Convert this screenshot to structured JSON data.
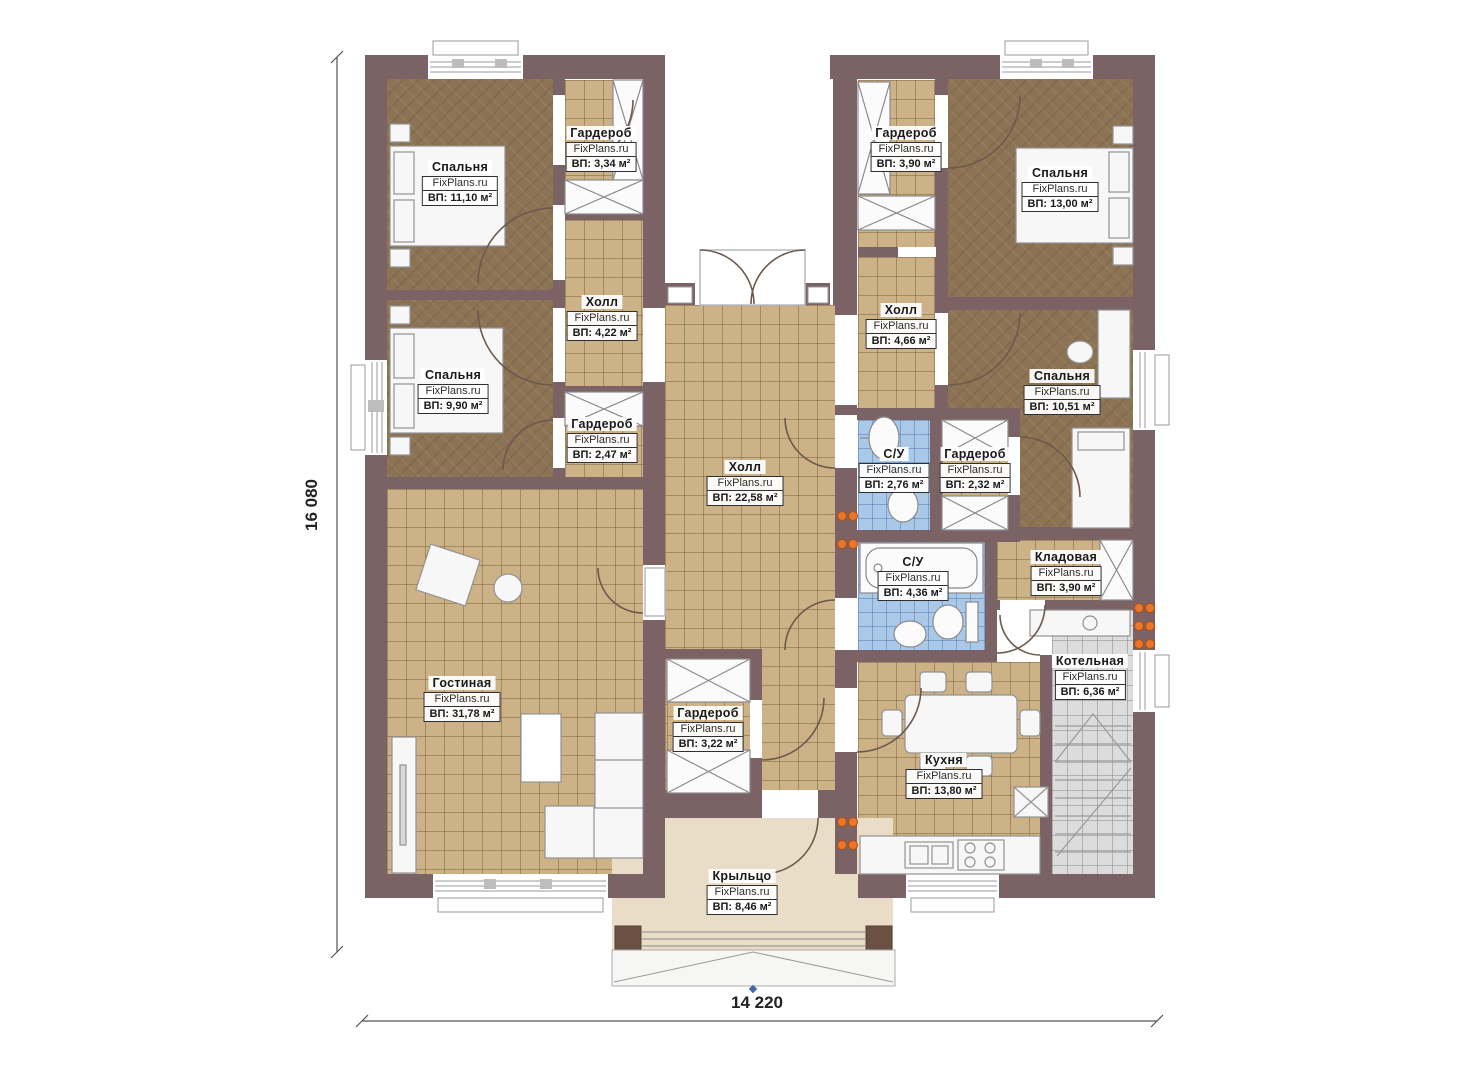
{
  "plan": {
    "brand": "FixPlans.ru",
    "dimension_left": "16 080",
    "dimension_bottom": "14 220",
    "rooms": [
      {
        "id": "bedroom-1",
        "name": "Спальня",
        "area": "ВП: 11,10 м²"
      },
      {
        "id": "wardrobe-1",
        "name": "Гардероб",
        "area": "ВП: 3,34 м²"
      },
      {
        "id": "hall-1",
        "name": "Холл",
        "area": "ВП: 4,22 м²"
      },
      {
        "id": "bedroom-2",
        "name": "Спальня",
        "area": "ВП: 9,90 м²"
      },
      {
        "id": "wardrobe-2",
        "name": "Гардероб",
        "area": "ВП: 2,47 м²"
      },
      {
        "id": "central-hall",
        "name": "Холл",
        "area": "ВП: 22,58 м²"
      },
      {
        "id": "living-room",
        "name": "Гостиная",
        "area": "ВП: 31,78 м²"
      },
      {
        "id": "wardrobe-3",
        "name": "Гардероб",
        "area": "ВП: 3,22 м²"
      },
      {
        "id": "porch",
        "name": "Крыльцо",
        "area": "ВП: 8,46 м²"
      },
      {
        "id": "wardrobe-4",
        "name": "Гардероб",
        "area": "ВП: 3,90 м²"
      },
      {
        "id": "bedroom-3",
        "name": "Спальня",
        "area": "ВП: 13,00 м²"
      },
      {
        "id": "hall-2",
        "name": "Холл",
        "area": "ВП: 4,66 м²"
      },
      {
        "id": "bedroom-4",
        "name": "Спальня",
        "area": "ВП: 10,51 м²"
      },
      {
        "id": "bathroom-1",
        "name": "С/У",
        "area": "ВП: 2,76 м²"
      },
      {
        "id": "wardrobe-5",
        "name": "Гардероб",
        "area": "ВП: 2,32 м²"
      },
      {
        "id": "bathroom-2",
        "name": "С/У",
        "area": "ВП: 4,36 м²"
      },
      {
        "id": "storage",
        "name": "Кладовая",
        "area": "ВП: 3,90 м²"
      },
      {
        "id": "boiler-room",
        "name": "Котельная",
        "area": "ВП: 6,36 м²"
      },
      {
        "id": "kitchen",
        "name": "Кухня",
        "area": "ВП: 13,80 м²"
      }
    ]
  }
}
